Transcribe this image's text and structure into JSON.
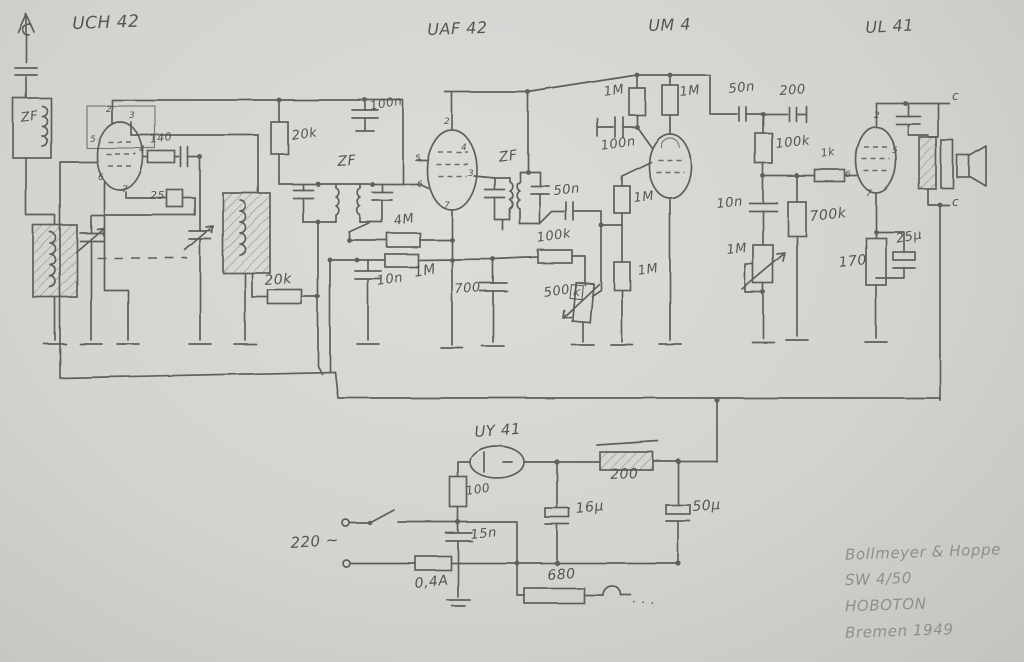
{
  "colors": {
    "paper": "#d5d3d0",
    "pencil": "#5f5e5b",
    "pencil_text": "#56554f",
    "pencil_light": "#8f8e8a"
  },
  "signature": {
    "lines": [
      "Bollmeyer & Hoppe",
      "SW 4/50",
      "HOBOTON",
      "Bremen 1949"
    ]
  },
  "labels": [
    {
      "name": "tube-label-uch42",
      "text": "UCH 42",
      "x": 72,
      "y": 16,
      "fs": 17,
      "rot": -2
    },
    {
      "name": "tube-label-uaf42",
      "text": "UAF 42",
      "x": 427,
      "y": 22,
      "fs": 16,
      "rot": -2
    },
    {
      "name": "tube-label-um4",
      "text": "UM 4",
      "x": 648,
      "y": 18,
      "fs": 16,
      "rot": -2
    },
    {
      "name": "tube-label-ul41",
      "text": "UL 41",
      "x": 865,
      "y": 20,
      "fs": 16,
      "rot": -3
    },
    {
      "name": "tube-label-uy41",
      "text": "UY 41",
      "x": 474,
      "y": 425,
      "fs": 15,
      "rot": -4
    },
    {
      "name": "antenna-coil-label",
      "text": "ZF",
      "x": 20,
      "y": 112,
      "fs": 13,
      "rot": -8
    },
    {
      "name": "resistor-140-label",
      "text": "140",
      "x": 149,
      "y": 134,
      "fs": 11,
      "rot": -8
    },
    {
      "name": "resistor-25-label",
      "text": "25",
      "x": 150,
      "y": 190,
      "fs": 11,
      "rot": 0
    },
    {
      "name": "resistor-20k-top-label",
      "text": "20k",
      "x": 291,
      "y": 130,
      "fs": 13,
      "rot": -8
    },
    {
      "name": "cap-100n-top-label",
      "text": "100n",
      "x": 369,
      "y": 100,
      "fs": 12,
      "rot": -10
    },
    {
      "name": "if1-label",
      "text": "ZF",
      "x": 337,
      "y": 155,
      "fs": 14,
      "rot": -4
    },
    {
      "name": "if2-label",
      "text": "ZF",
      "x": 498,
      "y": 151,
      "fs": 14,
      "rot": -8
    },
    {
      "name": "resistor-4m-label",
      "text": "4M",
      "x": 393,
      "y": 215,
      "fs": 13,
      "rot": -8
    },
    {
      "name": "resistor-1m-mid-label",
      "text": "1M",
      "x": 413,
      "y": 266,
      "fs": 14,
      "rot": -10
    },
    {
      "name": "cap-10n-mid-label",
      "text": "10n",
      "x": 376,
      "y": 275,
      "fs": 13,
      "rot": -8
    },
    {
      "name": "cap-700-label",
      "text": "700",
      "x": 454,
      "y": 283,
      "fs": 13,
      "rot": -4
    },
    {
      "name": "resistor-20k-lower-label",
      "text": "20k",
      "x": 264,
      "y": 274,
      "fs": 14,
      "rot": -4
    },
    {
      "name": "resistor-100k-det-label",
      "text": "100k",
      "x": 536,
      "y": 232,
      "fs": 13,
      "rot": -8
    },
    {
      "name": "pot-500k-label",
      "text": "500",
      "x": 543,
      "y": 287,
      "fs": 13,
      "rot": -8
    },
    {
      "name": "pot-500k-k-label",
      "text": "k",
      "x": 571,
      "y": 284,
      "fs": 12,
      "rot": 6,
      "boxed": true
    },
    {
      "name": "cap-50n-det-label",
      "text": "50n",
      "x": 553,
      "y": 185,
      "fs": 13,
      "rot": -6
    },
    {
      "name": "resistor-1m-a-label",
      "text": "1M",
      "x": 633,
      "y": 192,
      "fs": 13,
      "rot": -6
    },
    {
      "name": "resistor-1m-b-label",
      "text": "1M",
      "x": 637,
      "y": 265,
      "fs": 13,
      "rot": -8
    },
    {
      "name": "resistor-1m-um4-left-label",
      "text": "1M",
      "x": 603,
      "y": 86,
      "fs": 13,
      "rot": -8
    },
    {
      "name": "resistor-1m-um4-right-label",
      "text": "1M",
      "x": 679,
      "y": 86,
      "fs": 13,
      "rot": -6
    },
    {
      "name": "cap-100n-um4-label",
      "text": "100n",
      "x": 600,
      "y": 140,
      "fs": 13,
      "rot": -8
    },
    {
      "name": "cap-50n-right-label",
      "text": "50n",
      "x": 728,
      "y": 83,
      "fs": 13,
      "rot": -6
    },
    {
      "name": "cap-200-right-label",
      "text": "200",
      "x": 779,
      "y": 85,
      "fs": 13,
      "rot": -4
    },
    {
      "name": "resistor-100k-right-label",
      "text": "100k",
      "x": 775,
      "y": 138,
      "fs": 13,
      "rot": -6
    },
    {
      "name": "resistor-1k-label",
      "text": "1k",
      "x": 820,
      "y": 148,
      "fs": 11,
      "rot": -8
    },
    {
      "name": "cap-10n-right-label",
      "text": "10n",
      "x": 716,
      "y": 198,
      "fs": 13,
      "rot": -6
    },
    {
      "name": "resistor-700k-label",
      "text": "700k",
      "x": 809,
      "y": 210,
      "fs": 14,
      "rot": -6
    },
    {
      "name": "pot-1m-tone-label",
      "text": "1M",
      "x": 726,
      "y": 244,
      "fs": 13,
      "rot": -6
    },
    {
      "name": "resistor-170-label",
      "text": "170",
      "x": 838,
      "y": 256,
      "fs": 14,
      "rot": -6
    },
    {
      "name": "cap-25u-label",
      "text": "25µ",
      "x": 895,
      "y": 233,
      "fs": 13,
      "rot": -10
    },
    {
      "name": "resistor-100-label",
      "text": "100",
      "x": 465,
      "y": 485,
      "fs": 12,
      "rot": -8
    },
    {
      "name": "resistor-200-bottom-label",
      "text": "200",
      "x": 610,
      "y": 468,
      "fs": 14,
      "rot": -2
    },
    {
      "name": "cap-16u-label",
      "text": "16µ",
      "x": 575,
      "y": 502,
      "fs": 14,
      "rot": -6
    },
    {
      "name": "cap-50u-label",
      "text": "50µ",
      "x": 692,
      "y": 500,
      "fs": 14,
      "rot": -4
    },
    {
      "name": "cap-15n-label",
      "text": "15n",
      "x": 470,
      "y": 529,
      "fs": 13,
      "rot": -6
    },
    {
      "name": "mains-voltage-label",
      "text": "220 ∼",
      "x": 290,
      "y": 536,
      "fs": 15,
      "rot": -4
    },
    {
      "name": "fuse-label",
      "text": "0,4A",
      "x": 414,
      "y": 577,
      "fs": 14,
      "rot": -6
    },
    {
      "name": "resistor-680-label",
      "text": "680",
      "x": 547,
      "y": 569,
      "fs": 14,
      "rot": -4
    },
    {
      "name": "terminal-c-top-label",
      "text": "c",
      "x": 952,
      "y": 90,
      "fs": 12,
      "rot": 0
    },
    {
      "name": "terminal-c-bottom-label",
      "text": "c",
      "x": 952,
      "y": 196,
      "fs": 12,
      "rot": 0
    },
    {
      "name": "heater-dots",
      "text": "· · ·",
      "x": 632,
      "y": 596,
      "fs": 13,
      "rot": 4
    },
    {
      "name": "pin-uch42-2",
      "text": "2",
      "x": 106,
      "y": 106,
      "fs": 9,
      "rot": 0
    },
    {
      "name": "pin-uch42-3",
      "text": "3",
      "x": 129,
      "y": 112,
      "fs": 9,
      "rot": 0
    },
    {
      "name": "pin-uch42-5",
      "text": "5",
      "x": 90,
      "y": 136,
      "fs": 9,
      "rot": 0
    },
    {
      "name": "pin-uch42-4",
      "text": "4",
      "x": 139,
      "y": 146,
      "fs": 9,
      "rot": 0
    },
    {
      "name": "pin-uch42-6",
      "text": "6",
      "x": 98,
      "y": 174,
      "fs": 9,
      "rot": 0
    },
    {
      "name": "pin-uch42-7",
      "text": "7",
      "x": 122,
      "y": 186,
      "fs": 9,
      "rot": 0
    },
    {
      "name": "pin-uaf42-2",
      "text": "2",
      "x": 444,
      "y": 118,
      "fs": 9,
      "rot": 0
    },
    {
      "name": "pin-uaf42-4",
      "text": "4",
      "x": 461,
      "y": 144,
      "fs": 9,
      "rot": 0
    },
    {
      "name": "pin-uaf42-5",
      "text": "5",
      "x": 415,
      "y": 155,
      "fs": 9,
      "rot": 0
    },
    {
      "name": "pin-uaf42-3",
      "text": "3",
      "x": 468,
      "y": 170,
      "fs": 9,
      "rot": 0
    },
    {
      "name": "pin-uaf42-6",
      "text": "6",
      "x": 417,
      "y": 181,
      "fs": 9,
      "rot": 0
    },
    {
      "name": "pin-uaf42-7",
      "text": "7",
      "x": 444,
      "y": 202,
      "fs": 9,
      "rot": 0
    },
    {
      "name": "pin-ul41-2",
      "text": "2",
      "x": 874,
      "y": 112,
      "fs": 9,
      "rot": 0
    },
    {
      "name": "pin-ul41-5",
      "text": "5",
      "x": 892,
      "y": 147,
      "fs": 9,
      "rot": 0
    },
    {
      "name": "pin-ul41-6",
      "text": "6",
      "x": 845,
      "y": 171,
      "fs": 9,
      "rot": 0
    },
    {
      "name": "pin-ul41-7",
      "text": "7",
      "x": 866,
      "y": 190,
      "fs": 9,
      "rot": 0
    }
  ]
}
